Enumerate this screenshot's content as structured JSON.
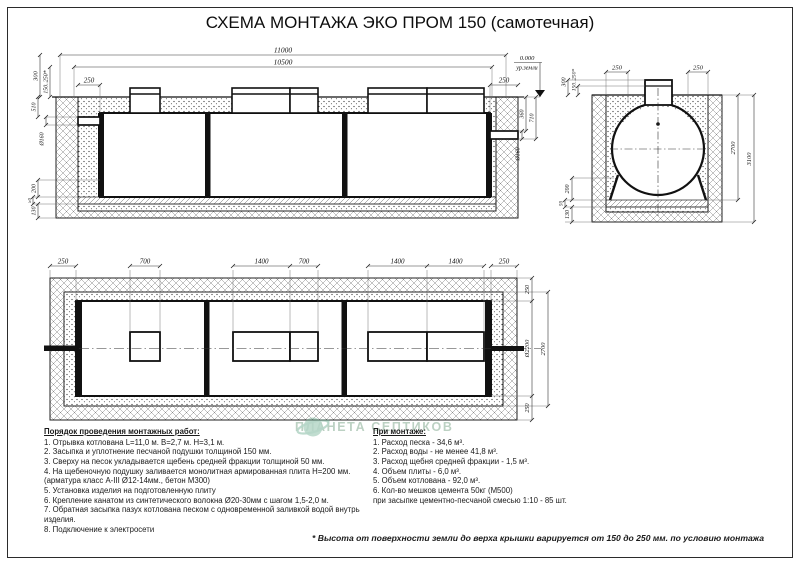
{
  "title": "СХЕМА МОНТАЖА ЭКО ПРОМ 150 (самотечная)",
  "colors": {
    "line": "#1a1a1a",
    "watermark_green": "#76a98c"
  },
  "side_view": {
    "dims": {
      "total_length": "11000",
      "tank_length": "10500",
      "left_gap": "250",
      "right_gap": "250",
      "level_mark": "0.000",
      "level_label": "ур.земли",
      "cover_height": "300",
      "ground_variation": "150..250*",
      "inlet_depth": "510",
      "inlet_pipe": "Ø160",
      "bed_sand": "200",
      "bed_gravel": "50",
      "bed_slab": "130",
      "outlet_offset": "360",
      "outlet_depth": "710",
      "outlet_pipe": "Ø160"
    }
  },
  "end_view": {
    "dims": {
      "cover_height": "300",
      "ground_variation": "150..250*",
      "left_gap": "250",
      "right_gap": "250",
      "tank_depth": "2700",
      "pit_depth": "3100",
      "bed_sand": "200",
      "bed_gravel": "50",
      "bed_slab": "130"
    }
  },
  "plan_view": {
    "dims": {
      "chain": [
        "250",
        "700",
        "1400",
        "700",
        "1400",
        "1400",
        "250"
      ],
      "right_top": "250",
      "tank_diameter": "Ø2200",
      "pit_width": "2700",
      "right_bottom": "250"
    }
  },
  "procedure": {
    "heading": "Порядок проведения монтажных работ:",
    "items": [
      "1. Отрывка котлована L=11,0 м. B=2,7 м. H=3,1 м.",
      "2. Засыпка и уплотнение песчаной подушки толщиной 150 мм.",
      "3. Сверху на песок укладывается щебень средней фракции толщиной 50 мм.",
      "4. На щебеночную подушку заливается монолитная армированная плита Н=200 мм.",
      "(арматура класс А-III Ø12-14мм., бетон М300)",
      "5. Установка изделия на подготовленную плиту",
      "6. Крепление канатом из синтетического волокна Ø20-30мм с шагом 1,5-2,0 м.",
      "7. Обратная засыпка пазух котлована песком с одновременной заливкой водой внутрь изделия.",
      "8. Подключение к электросети"
    ]
  },
  "montage": {
    "heading": "При монтаже:",
    "items": [
      "1. Расход песка - 34,6 м³.",
      "2. Расход воды - не менее 41,8 м³.",
      "3. Расход щебня средней фракции - 1,5 м³.",
      "4. Объем плиты - 6,0 м³.",
      "5. Объем котлована - 92,0 м³.",
      "6. Кол-во мешков цемента 50кг (М500)",
      "при засыпке цементно-песчаной смесью 1:10 - 85 шт."
    ]
  },
  "footnote": "* Высота от поверхности земли до верха крышки варируется от 150 до 250 мм. по условию монтажа",
  "watermark": {
    "text": "ПЛАНЕТА СЕПТИКОВ"
  }
}
